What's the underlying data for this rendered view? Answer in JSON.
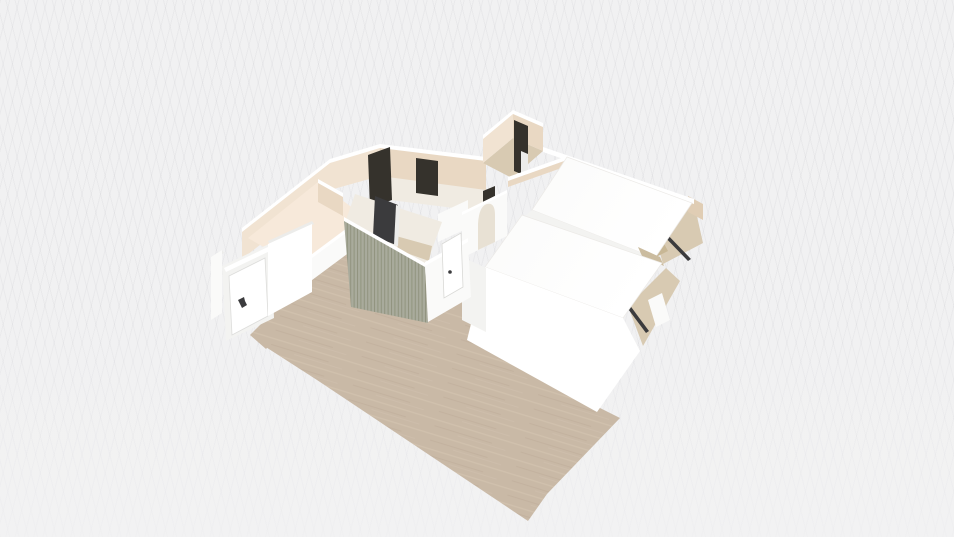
{
  "scene": {
    "name": "3d-floorplan-render",
    "description": "Elevated three-quarter 3D view of an apartment floor plan on a faint grid backdrop",
    "rooms": [
      "living-area-wood-floor",
      "kitchen-cream-room",
      "center-closet-slatted",
      "hallway-with-arch",
      "bedroom-upper-white-roof",
      "bedroom-lower-white-roof",
      "storage-room-top",
      "east-corner-room"
    ],
    "features": [
      "entrance-door-with-handle",
      "closet-white-door-with-handle",
      "dark-doorway-left",
      "dark-doorway-middle",
      "dark-door-storage-room",
      "dark-window-panel-closet",
      "arched-opening",
      "dark-sliding-door-bedroom-1",
      "dark-sliding-door-bedroom-2",
      "tan-dresser-blocks"
    ]
  },
  "colors": {
    "background": "#f1f1f2",
    "wood": "#c9b9a6",
    "wood_light": "#d4c6b3",
    "wood_dark": "#bdac98",
    "cream": "#f1e3d2",
    "cream_dark": "#e9d8c3",
    "cream_deep": "#e0cdb4",
    "cream_floor": "#f7e9da",
    "beige": "#d8cab2",
    "beige_dark": "#cbbc9f",
    "tan": "#c8b795",
    "slat": "#a9ab9c",
    "slat_line": "#91947f",
    "dark": "#35322c",
    "dark2": "#3b3b3d",
    "white": "#ffffff",
    "white_soft": "#fafaf9",
    "white_shade": "#f3f3f1",
    "white_dim": "#ececea",
    "interior": "#f0ebe2",
    "arch_opening": "#e8e1d4",
    "edge": "#e9e8e5"
  }
}
